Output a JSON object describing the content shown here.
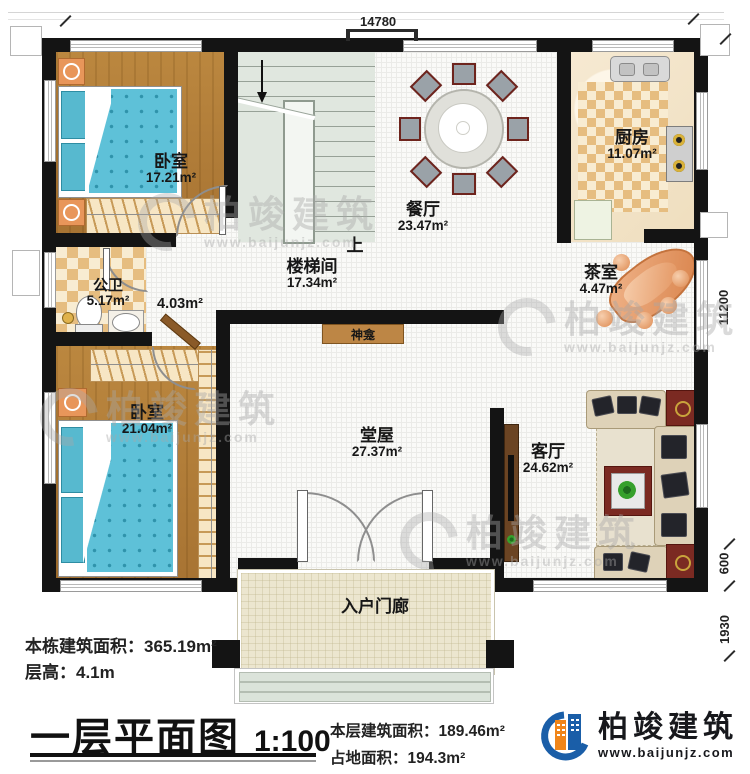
{
  "title": {
    "main": "一层平面图",
    "scale": "1:100"
  },
  "rooms": {
    "bedroom1": {
      "name": "卧室",
      "area": "17.21m²"
    },
    "bedroom2": {
      "name": "卧室",
      "area": "21.04m²"
    },
    "dining": {
      "name": "餐厅",
      "area": "23.47m²"
    },
    "kitchen": {
      "name": "厨房",
      "area": "11.07m²"
    },
    "stairwell": {
      "name": "楼梯间",
      "area": "17.34m²"
    },
    "bathroom": {
      "name": "公卫",
      "area": "5.17m²"
    },
    "corridor": {
      "area": "4.03m²"
    },
    "tearoom": {
      "name": "茶室",
      "area": "4.47m²"
    },
    "hall": {
      "name": "堂屋",
      "area": "27.37m²"
    },
    "living": {
      "name": "客厅",
      "area": "24.62m²"
    },
    "porch": {
      "name": "入户门廊"
    },
    "shrine": {
      "name": "神龛"
    },
    "up": "上"
  },
  "dimensions": {
    "top": "14780",
    "right_height": "11200",
    "right_upper": "600",
    "right_lower": "1930"
  },
  "stats": {
    "total_area_label": "本栋建筑面积：",
    "total_area": "365.19m²",
    "floor_height_label": "层高：",
    "floor_height": "4.1m",
    "floor_area_label": "本层建筑面积：",
    "floor_area": "189.46m²",
    "footprint_label": "占地面积：",
    "footprint": "194.3m²"
  },
  "brand": {
    "name": "柏竣建筑",
    "url": "www.baijunjz.com"
  },
  "watermark": {
    "name": "柏竣建筑",
    "url": "www.baijunjz.com"
  }
}
